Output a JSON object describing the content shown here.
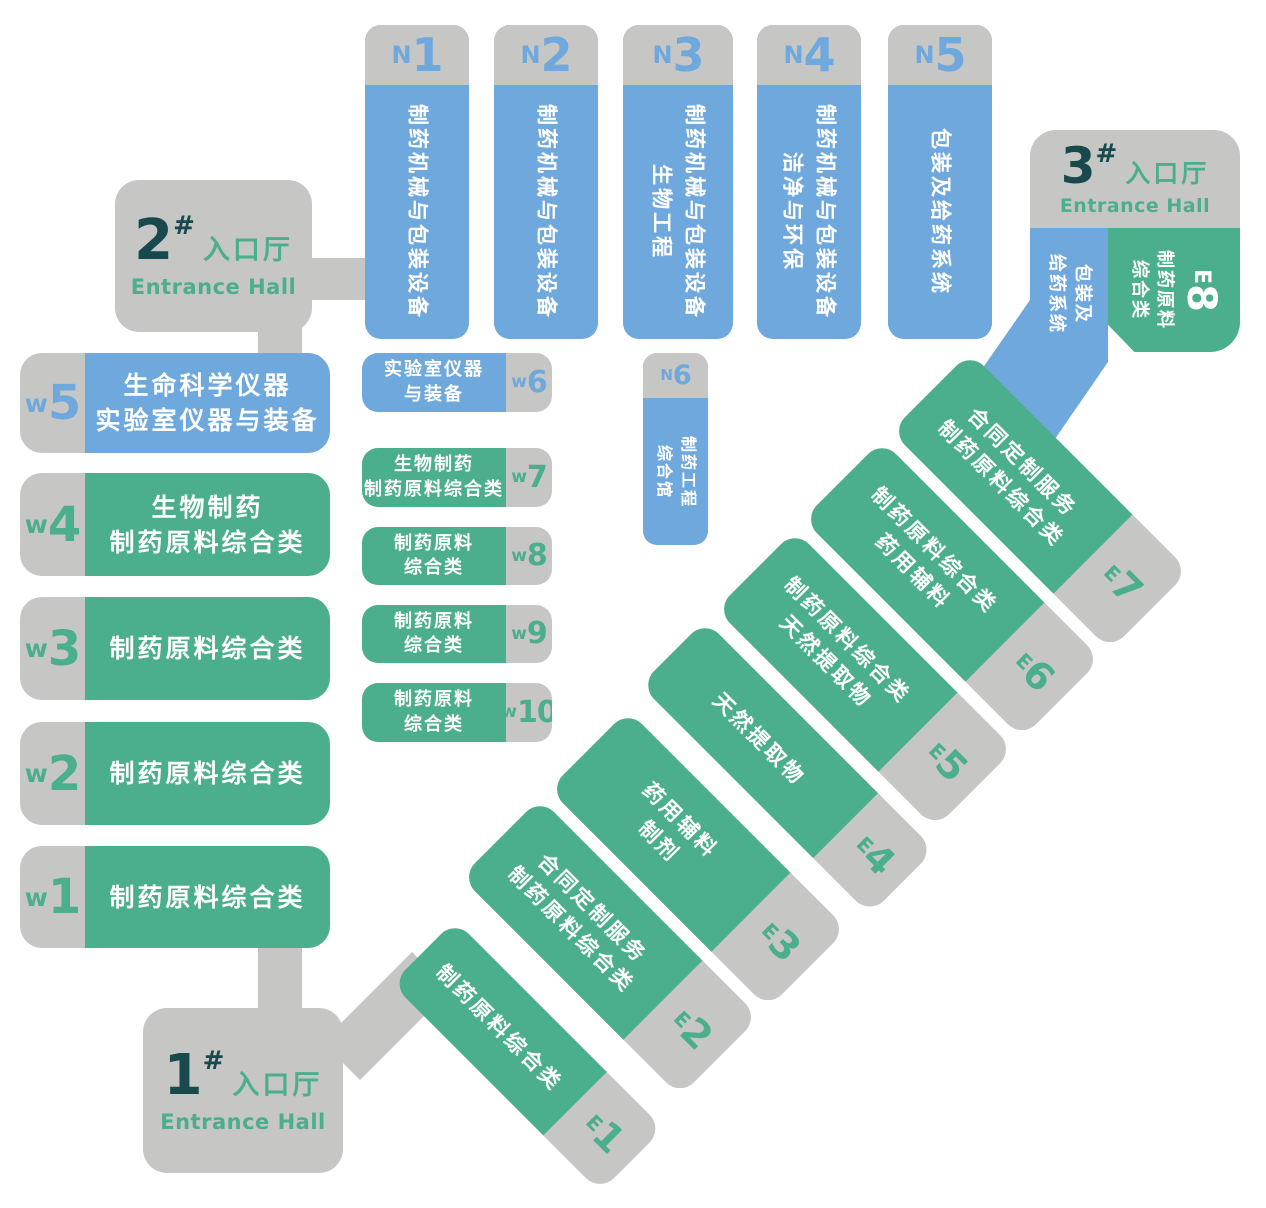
{
  "colors": {
    "blue": "#6FA8DC",
    "green": "#4BAE8D",
    "gray": "#C6C6C5",
    "dark_teal": "#17494D",
    "text_on_fill": "#FFFFFF"
  },
  "entrances": {
    "hall1": {
      "num": "1",
      "hash": "#",
      "cn": "入口厅",
      "en": "Entrance Hall"
    },
    "hall2": {
      "num": "2",
      "hash": "#",
      "cn": "入口厅",
      "en": "Entrance Hall"
    },
    "hall3": {
      "num": "3",
      "hash": "#",
      "cn": "入口厅",
      "en": "Entrance Hall"
    }
  },
  "north_halls": [
    {
      "letter": "N",
      "num": "1",
      "line1": "制药机械与包装设备"
    },
    {
      "letter": "N",
      "num": "2",
      "line1": "制药机械与包装设备"
    },
    {
      "letter": "N",
      "num": "3",
      "line1": "制药机械与包装设备",
      "line2": "生物工程"
    },
    {
      "letter": "N",
      "num": "4",
      "line1": "制药机械与包装设备",
      "line2": "洁净与环保"
    },
    {
      "letter": "N",
      "num": "5",
      "line1": "包装及给药系统"
    },
    {
      "letter": "N",
      "num": "6",
      "line1": "制药工程",
      "line2": "综合馆"
    }
  ],
  "west_halls": [
    {
      "letter": "w",
      "num": "5",
      "line1": "生命科学仪器",
      "line2": "实验室仪器与装备",
      "color": "blue"
    },
    {
      "letter": "w",
      "num": "4",
      "line1": "生物制药",
      "line2": "制药原料综合类",
      "color": "green"
    },
    {
      "letter": "w",
      "num": "3",
      "line1": "制药原料综合类",
      "color": "green"
    },
    {
      "letter": "w",
      "num": "2",
      "line1": "制药原料综合类",
      "color": "green"
    },
    {
      "letter": "w",
      "num": "1",
      "line1": "制药原料综合类",
      "color": "green"
    }
  ],
  "small_west_halls": [
    {
      "letter": "w",
      "num": "6",
      "line1": "实验室仪器",
      "line2": "与装备",
      "color": "blue"
    },
    {
      "letter": "w",
      "num": "7",
      "line1": "生物制药",
      "line2": "制药原料综合类",
      "color": "green"
    },
    {
      "letter": "w",
      "num": "8",
      "line1": "制药原料",
      "line2": "综合类",
      "color": "green"
    },
    {
      "letter": "w",
      "num": "9",
      "line1": "制药原料",
      "line2": "综合类",
      "color": "green"
    },
    {
      "letter": "w",
      "num": "10",
      "line1": "制药原料",
      "line2": "综合类",
      "color": "green"
    }
  ],
  "east_halls": [
    {
      "letter": "E",
      "num": "1",
      "line1": "制药原料综合类"
    },
    {
      "letter": "E",
      "num": "2",
      "line1": "合同定制服务",
      "line2": "制药原料综合类"
    },
    {
      "letter": "E",
      "num": "3",
      "line1": "药用辅料",
      "line2": "制剂"
    },
    {
      "letter": "E",
      "num": "4",
      "line1": "天然提取物"
    },
    {
      "letter": "E",
      "num": "5",
      "line1": "制药原料综合类",
      "line2": "天然提取物"
    },
    {
      "letter": "E",
      "num": "6",
      "line1": "制药原料综合类",
      "line2": "药用辅料"
    },
    {
      "letter": "E",
      "num": "7",
      "line1": "合同定制服务",
      "line2": "制药原料综合类"
    },
    {
      "letter": "E",
      "num": "8",
      "line1": "制药原料",
      "line2": "综合类"
    }
  ],
  "e8_blue_strip": {
    "line1": "包装及",
    "line2": "给药系统"
  }
}
